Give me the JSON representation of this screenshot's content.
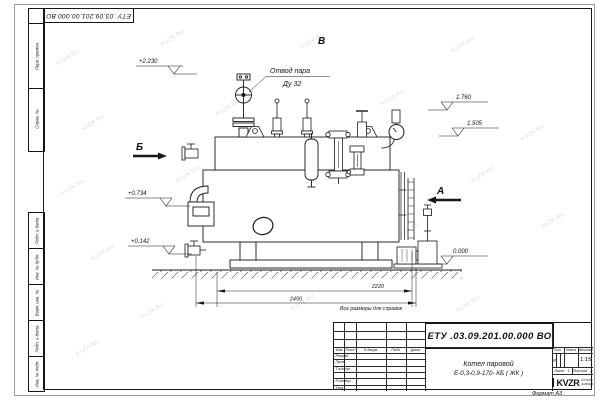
{
  "watermark": "KVZR.RU",
  "corner_stamp": "ЕТУ .03.09.201.00.000  ВО",
  "margin_labels": {
    "perv": "Перв. примен.",
    "sprav": "Справ. №",
    "podp1": "Подп. и дата",
    "inv_dubl": "Инв. № дубл.",
    "vzam": "Взам. инв. №",
    "podp2": "Подп. и дата",
    "inv_podl": "Инв. № подл."
  },
  "drawing": {
    "callout_line1": "Отвод пара",
    "callout_line2": "Ду 32",
    "view_top": "В",
    "view_left": "Б",
    "view_right": "А",
    "elev_2230": "+2.230",
    "elev_1760": "1.760",
    "elev_1505": "1.505",
    "elev_0734": "+0.734",
    "elev_0142": "+0.142",
    "elev_0000": "0.000",
    "dim_inner": "2220",
    "dim_outer": "2450",
    "note": "Все размеры для справок"
  },
  "title_block": {
    "doc_number": "ЕТУ .03.09.201.00.000  ВО",
    "product_line1": "Котел паровой",
    "product_line2": "Е-0,3-0,9-170- КБ ( ЖК )",
    "col_izm": "Изм",
    "col_list": "Лист",
    "col_doc": "N докум.",
    "col_podp": "Подп.",
    "col_data": "Дата",
    "row_razrab": "Разраб.",
    "row_prov": "Пров.",
    "row_tkontr": "Т.контр.",
    "row_nkontr": "Н.контр.",
    "row_utv": "Утв.",
    "lit_label": "Лит.",
    "mass_label": "Масса",
    "scale_label": "Масштаб",
    "lit_value": "И",
    "scale_value": "1:15",
    "sheet_label": "Лист",
    "sheet_value": "1",
    "sheets_label": "Листов",
    "sheets_value": "2",
    "logo_text": "KVZR",
    "logo_sub1": "КОТЕЛЬНЫЙ",
    "logo_sub2": "ЗАВОД РЭП",
    "format_label": "Формат А3"
  }
}
